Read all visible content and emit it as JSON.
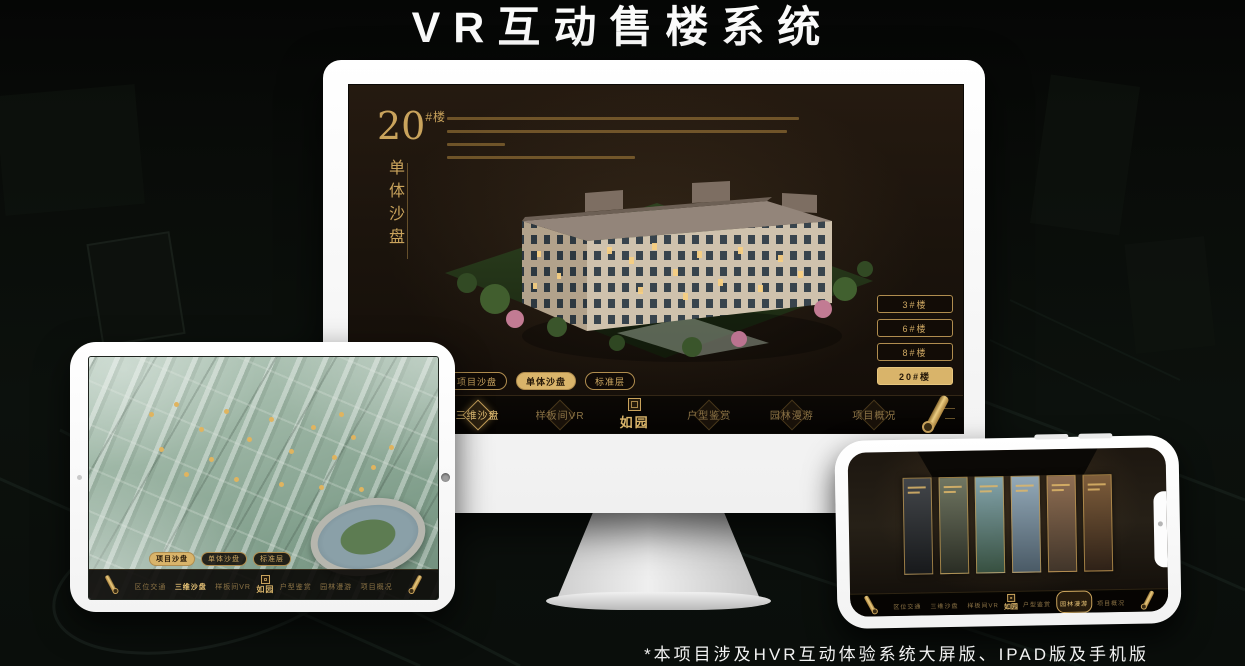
{
  "title": "VR互动售楼系统",
  "footnote": "*本项目涉及HVR互动体验系统大屏版、IPAD版及手机版",
  "colors": {
    "gold": "#c9a35c",
    "gold_bright": "#e6c47e",
    "screen_bg": "#1d150d",
    "nav_bg": "#0a0705"
  },
  "monitor": {
    "headline": {
      "number": "20",
      "suffix": "#楼",
      "title_vertical": "单体沙盘"
    },
    "floor_buttons": [
      {
        "label": "3#楼",
        "selected": false
      },
      {
        "label": "6#楼",
        "selected": false
      },
      {
        "label": "8#楼",
        "selected": false
      },
      {
        "label": "20#楼",
        "selected": true
      }
    ],
    "sub_tabs": [
      {
        "label": "项目沙盘",
        "selected": false
      },
      {
        "label": "单体沙盘",
        "selected": true
      },
      {
        "label": "标准层",
        "selected": false
      }
    ],
    "nav": {
      "logo": "如园",
      "items": [
        {
          "label": "区位交通",
          "active": false
        },
        {
          "label": "三维沙盘",
          "active": true
        },
        {
          "label": "样板间VR",
          "active": false
        },
        {
          "label": "户型鉴赏",
          "active": false
        },
        {
          "label": "园林漫游",
          "active": false
        },
        {
          "label": "项目概况",
          "active": false
        }
      ]
    }
  },
  "tablet": {
    "sub_tabs": [
      {
        "label": "项目沙盘",
        "selected": true
      },
      {
        "label": "单体沙盘",
        "selected": false
      },
      {
        "label": "标准层",
        "selected": false
      }
    ],
    "nav": {
      "logo": "如园",
      "items": [
        {
          "label": "区位交通",
          "active": false
        },
        {
          "label": "三维沙盘",
          "active": true
        },
        {
          "label": "样板间VR",
          "active": false
        },
        {
          "label": "户型鉴赏",
          "active": false
        },
        {
          "label": "园林漫游",
          "active": false
        },
        {
          "label": "项目概况",
          "active": false
        }
      ]
    }
  },
  "phone": {
    "nav": {
      "logo": "如园",
      "items": [
        {
          "label": "区位交通",
          "active": false
        },
        {
          "label": "三维沙盘",
          "active": false
        },
        {
          "label": "样板间VR",
          "active": false
        },
        {
          "label": "户型鉴赏",
          "active": false
        },
        {
          "label": "园林漫游",
          "active": true
        },
        {
          "label": "项目概况",
          "active": false
        }
      ]
    }
  }
}
